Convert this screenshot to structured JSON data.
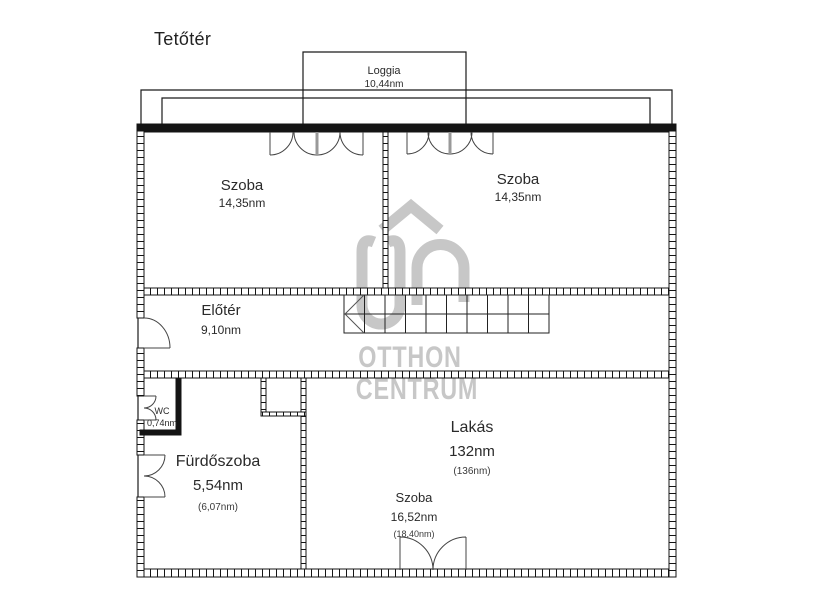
{
  "page": {
    "title": "Tetőtér"
  },
  "floorplan": {
    "rooms": {
      "loggia": {
        "name": "Loggia",
        "area": "10,44nm"
      },
      "szoba_left": {
        "name": "Szoba",
        "area": "14,35nm"
      },
      "szoba_right": {
        "name": "Szoba",
        "area": "14,35nm"
      },
      "eloter": {
        "name": "Előtér",
        "area": "9,10nm"
      },
      "wc": {
        "name": "WC",
        "area": "0,74nm"
      },
      "furdoszoba": {
        "name": "Fürdőszoba",
        "area": "5,54nm",
        "area_gross": "(6,07nm)"
      },
      "lakas": {
        "name": "Lakás",
        "area": "132nm",
        "area_gross": "(136nm)"
      },
      "szoba_bottom": {
        "name": "Szoba",
        "area": "16,52nm",
        "area_gross": "(18,40nm)"
      }
    },
    "watermark": {
      "brand_line1": "OTTHON",
      "brand_line2": "CENTRUM",
      "logo": "oc-house-logo",
      "color": "#c7c7c7"
    },
    "colors": {
      "wall": "#141414",
      "thin_line": "#2a2a2a",
      "door_line": "#555555",
      "text": "#2a2a2a"
    }
  }
}
